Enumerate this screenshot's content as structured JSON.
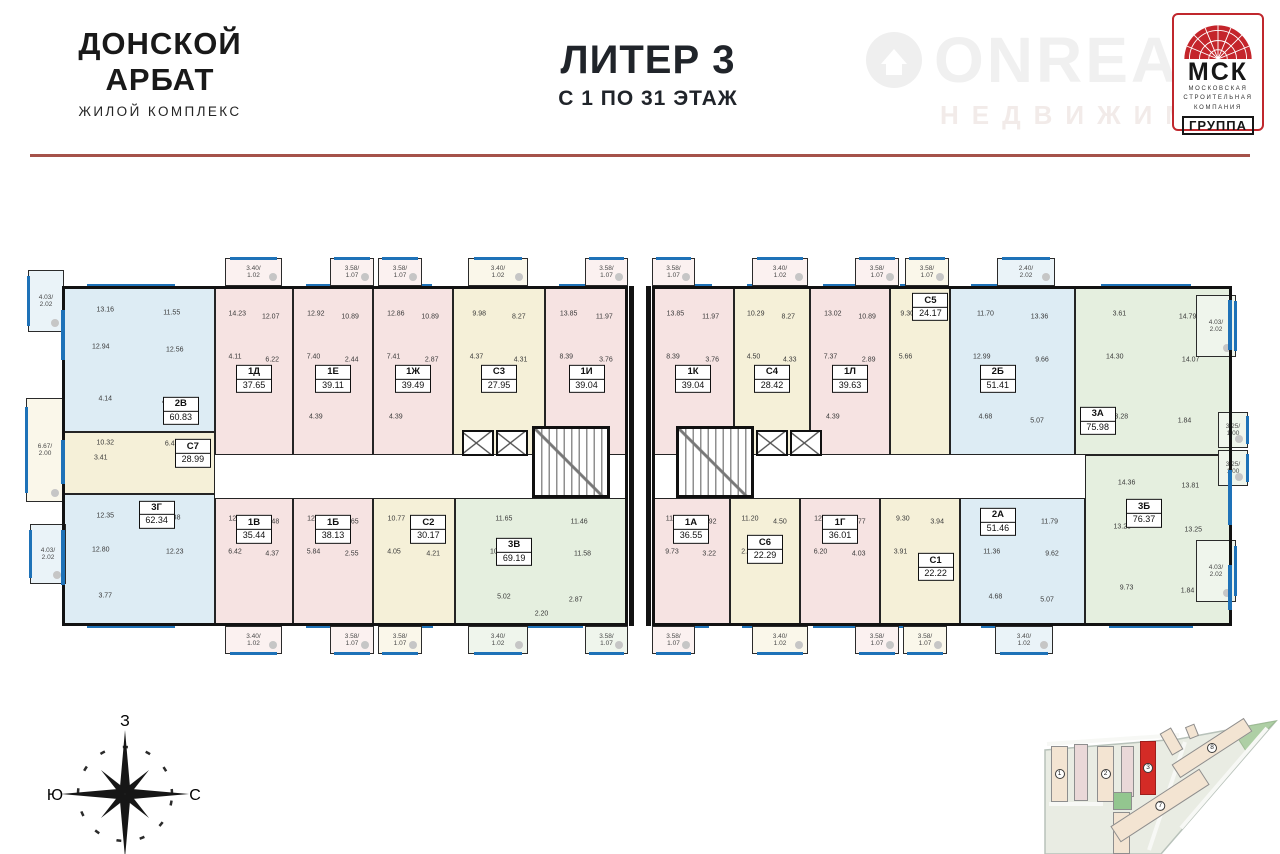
{
  "header": {
    "logo": {
      "line1": "ДОНСКОЙ",
      "line2": "АРБАТ",
      "subtitle": "ЖИЛОЙ КОМПЛЕКС"
    },
    "title": {
      "line1": "ЛИТЕР 3",
      "line2": "С 1 ПО 31 ЭТАЖ"
    },
    "watermark": {
      "word": "ONREA",
      "sub": "НЕДВИЖИМ"
    },
    "msk": {
      "abbr": "МСК",
      "lines": [
        "МОСКОВСКАЯ",
        "СТРОИТЕЛЬНАЯ",
        "КОМПАНИЯ"
      ],
      "group": "ГРУППА"
    }
  },
  "colors": {
    "apt": {
      "pink": "#f6e3e2",
      "blue": "#ddecf4",
      "cream": "#f5f0d8",
      "green": "#e5efdf"
    },
    "balc": {
      "pink": "#fbf1f0",
      "cream": "#faf7ea",
      "blue": "#eaf3f8",
      "green": "#eff5ec",
      "white": "#ffffff"
    },
    "window": "#1e72b8",
    "divider": "#a5524a",
    "site_red": "#d42b26"
  },
  "plan": {
    "apartments": [
      {
        "id": "2В",
        "area": "60.83",
        "c": "blue",
        "row": "top",
        "rect": [
          62,
          286,
          153,
          146
        ],
        "lx": 78,
        "ly": 86,
        "rooms": [
          "13.16",
          "11.55",
          "12.94",
          "12.56",
          "4.14",
          "4.46"
        ]
      },
      {
        "id": "С7",
        "area": "28.99",
        "c": "cream",
        "row": "mid",
        "rect": [
          62,
          432,
          153,
          62
        ],
        "lx": 86,
        "ly": 34,
        "rooms": [
          "10.32",
          "6.42",
          "3.41"
        ]
      },
      {
        "id": "3Г",
        "area": "62.34",
        "c": "blue",
        "row": "bottom",
        "rect": [
          62,
          494,
          153,
          132
        ],
        "lx": 62,
        "ly": 15,
        "rooms": [
          "12.35",
          "12.38",
          "12.80",
          "12.23",
          "3.77"
        ]
      },
      {
        "id": "1Д",
        "area": "37.65",
        "c": "pink",
        "row": "top",
        "rect": [
          215,
          286,
          78,
          169
        ],
        "rooms": [
          "14.23",
          "12.07",
          "4.11",
          "6.22"
        ]
      },
      {
        "id": "1Е",
        "area": "39.11",
        "c": "pink",
        "row": "top",
        "rect": [
          293,
          286,
          80,
          169
        ],
        "rooms": [
          "12.92",
          "10.89",
          "7.40",
          "2.44",
          "4.39"
        ]
      },
      {
        "id": "1Ж",
        "area": "39.49",
        "c": "pink",
        "row": "top",
        "rect": [
          373,
          286,
          80,
          169
        ],
        "rooms": [
          "12.86",
          "10.89",
          "7.41",
          "2.87",
          "4.39"
        ]
      },
      {
        "id": "С3",
        "area": "27.95",
        "c": "cream",
        "row": "top",
        "rect": [
          453,
          286,
          92,
          169
        ],
        "rooms": [
          "9.98",
          "8.27",
          "4.37",
          "4.31"
        ]
      },
      {
        "id": "1И",
        "area": "39.04",
        "c": "pink",
        "row": "top",
        "rect": [
          545,
          286,
          83,
          169
        ],
        "rooms": [
          "13.85",
          "11.97",
          "8.39",
          "3.76"
        ]
      },
      {
        "id": "1В",
        "area": "35.44",
        "c": "pink",
        "row": "bottom",
        "rect": [
          215,
          498,
          78,
          128
        ],
        "rooms": [
          "12.15",
          "11.48",
          "6.42",
          "4.37"
        ]
      },
      {
        "id": "1Б",
        "area": "38.13",
        "c": "pink",
        "row": "bottom",
        "rect": [
          293,
          498,
          80,
          128
        ],
        "rooms": [
          "12.97",
          "11.65",
          "5.84",
          "2.55"
        ]
      },
      {
        "id": "С2",
        "area": "30.17",
        "c": "cream",
        "row": "bottom",
        "rect": [
          373,
          498,
          82,
          128
        ],
        "lx": 68,
        "rooms": [
          "10.77",
          "10.07",
          "4.05",
          "4.21"
        ]
      },
      {
        "id": "3В",
        "area": "69.19",
        "c": "green",
        "row": "bottom",
        "rect": [
          455,
          498,
          173,
          128
        ],
        "lx": 34,
        "ly": 42,
        "rooms": [
          "11.65",
          "11.46",
          "10.86",
          "11.58",
          "5.02",
          "2.87",
          "2.20"
        ]
      },
      {
        "id": "1К",
        "area": "39.04",
        "c": "pink",
        "row": "top",
        "rect": [
          652,
          286,
          82,
          169
        ],
        "rooms": [
          "13.85",
          "11.97",
          "8.39",
          "3.76"
        ]
      },
      {
        "id": "С4",
        "area": "28.42",
        "c": "cream",
        "row": "top",
        "rect": [
          734,
          286,
          76,
          169
        ],
        "rooms": [
          "10.29",
          "8.27",
          "4.50",
          "4.33"
        ]
      },
      {
        "id": "1Л",
        "area": "39.63",
        "c": "pink",
        "row": "top",
        "rect": [
          810,
          286,
          80,
          169
        ],
        "rooms": [
          "13.02",
          "10.89",
          "7.37",
          "2.89",
          "4.39"
        ]
      },
      {
        "id": "С5",
        "area": "24.17",
        "c": "cream",
        "row": "top",
        "rect": [
          890,
          286,
          60,
          169
        ],
        "lx": 68,
        "ly": 12,
        "rooms": [
          "9.30",
          "3.75",
          "5.66"
        ]
      },
      {
        "id": "2Б",
        "area": "51.41",
        "c": "blue",
        "row": "top",
        "rect": [
          950,
          286,
          125,
          169
        ],
        "lx": 38,
        "rooms": [
          "11.70",
          "13.36",
          "12.99",
          "9.66",
          "4.68",
          "5.07"
        ]
      },
      {
        "id": "3А",
        "area": "75.98",
        "c": "green",
        "row": "top",
        "rect": [
          1075,
          286,
          157,
          169
        ],
        "lx": 14,
        "ly": 80,
        "rooms": [
          "3.61",
          "14.79",
          "14.30",
          "14.07",
          "13.28",
          "1.84"
        ]
      },
      {
        "id": "1А",
        "area": "36.55",
        "c": "pink",
        "row": "bottom",
        "rect": [
          652,
          498,
          78,
          128
        ],
        "rooms": [
          "11.61",
          "10.92",
          "9.73",
          "3.22"
        ]
      },
      {
        "id": "С6",
        "area": "22.29",
        "c": "cream",
        "row": "bottom",
        "rect": [
          730,
          498,
          70,
          128
        ],
        "ly": 40,
        "rooms": [
          "11.20",
          "4.50",
          "2.34"
        ]
      },
      {
        "id": "1Г",
        "area": "36.01",
        "c": "pink",
        "row": "bottom",
        "rect": [
          800,
          498,
          80,
          128
        ],
        "rooms": [
          "12.92",
          "11.77",
          "6.20",
          "4.03"
        ]
      },
      {
        "id": "С1",
        "area": "22.22",
        "c": "cream",
        "row": "bottom",
        "rect": [
          880,
          498,
          80,
          128
        ],
        "lx": 70,
        "ly": 54,
        "rooms": [
          "9.30",
          "3.94",
          "3.91"
        ]
      },
      {
        "id": "2А",
        "area": "51.46",
        "c": "blue",
        "row": "bottom",
        "rect": [
          960,
          498,
          125,
          128
        ],
        "lx": 30,
        "ly": 18,
        "rooms": [
          "12.99",
          "11.79",
          "11.36",
          "9.62",
          "4.68",
          "5.07"
        ]
      },
      {
        "id": "3Б",
        "area": "76.37",
        "c": "green",
        "row": "bottom",
        "rect": [
          1085,
          455,
          147,
          171
        ],
        "lx": 40,
        "ly": 34,
        "rooms": [
          "14.36",
          "13.81",
          "13.28",
          "13.25",
          "9.73",
          "1.84"
        ]
      }
    ],
    "balconies": [
      {
        "edge": "top",
        "rect": [
          225,
          258,
          57,
          28
        ],
        "label": "3.40/1.02",
        "tint": "pink"
      },
      {
        "edge": "top",
        "rect": [
          330,
          258,
          44,
          28
        ],
        "label": "3.58/1.07",
        "tint": "pink"
      },
      {
        "edge": "top",
        "rect": [
          378,
          258,
          44,
          28
        ],
        "label": "3.58/1.07",
        "tint": "pink"
      },
      {
        "edge": "top",
        "rect": [
          468,
          258,
          60,
          28
        ],
        "label": "3.40/1.02",
        "tint": "cream"
      },
      {
        "edge": "top",
        "rect": [
          585,
          258,
          43,
          28
        ],
        "label": "3.58/1.07",
        "tint": "pink"
      },
      {
        "edge": "top",
        "rect": [
          652,
          258,
          43,
          28
        ],
        "label": "3.58/1.07",
        "tint": "pink"
      },
      {
        "edge": "top",
        "rect": [
          752,
          258,
          56,
          28
        ],
        "label": "3.40/1.02",
        "tint": "pink"
      },
      {
        "edge": "top",
        "rect": [
          855,
          258,
          44,
          28
        ],
        "label": "3.58/1.07",
        "tint": "pink"
      },
      {
        "edge": "top",
        "rect": [
          905,
          258,
          44,
          28
        ],
        "label": "3.58/1.07",
        "tint": "cream"
      },
      {
        "edge": "top",
        "rect": [
          997,
          258,
          58,
          28
        ],
        "label": "2.40/2.02",
        "tint": "blue"
      },
      {
        "edge": "bottom",
        "rect": [
          225,
          626,
          57,
          28
        ],
        "label": "3.40/1.02",
        "tint": "pink"
      },
      {
        "edge": "bottom",
        "rect": [
          330,
          626,
          44,
          28
        ],
        "label": "3.58/1.07",
        "tint": "pink"
      },
      {
        "edge": "bottom",
        "rect": [
          378,
          626,
          44,
          28
        ],
        "label": "3.58/1.07",
        "tint": "cream"
      },
      {
        "edge": "bottom",
        "rect": [
          468,
          626,
          60,
          28
        ],
        "label": "3.40/1.02",
        "tint": "green"
      },
      {
        "edge": "bottom",
        "rect": [
          585,
          626,
          43,
          28
        ],
        "label": "3.58/1.07",
        "tint": "green"
      },
      {
        "edge": "bottom",
        "rect": [
          652,
          626,
          43,
          28
        ],
        "label": "3.58/1.07",
        "tint": "pink"
      },
      {
        "edge": "bottom",
        "rect": [
          752,
          626,
          56,
          28
        ],
        "label": "3.40/1.02",
        "tint": "cream"
      },
      {
        "edge": "bottom",
        "rect": [
          855,
          626,
          44,
          28
        ],
        "label": "3.58/1.07",
        "tint": "pink"
      },
      {
        "edge": "bottom",
        "rect": [
          903,
          626,
          44,
          28
        ],
        "label": "3.58/1.07",
        "tint": "cream"
      },
      {
        "edge": "bottom",
        "rect": [
          995,
          626,
          58,
          28
        ],
        "label": "3.40/1.02",
        "tint": "blue"
      },
      {
        "edge": "left",
        "rect": [
          28,
          270,
          36,
          62
        ],
        "label": "4.03/2.02",
        "tint": "blue"
      },
      {
        "edge": "left",
        "rect": [
          26,
          398,
          38,
          104
        ],
        "label": "6.67/2.00",
        "tint": "cream"
      },
      {
        "edge": "left",
        "rect": [
          30,
          524,
          36,
          60
        ],
        "label": "4.03/2.02",
        "tint": "blue"
      },
      {
        "edge": "right",
        "rect": [
          1196,
          295,
          40,
          62
        ],
        "label": "4.03/2.02",
        "tint": "green"
      },
      {
        "edge": "right",
        "rect": [
          1218,
          412,
          30,
          36
        ],
        "label": "3.25/1.00",
        "tint": "green"
      },
      {
        "edge": "right",
        "rect": [
          1218,
          450,
          30,
          36
        ],
        "label": "3.25/1.00",
        "tint": "green"
      },
      {
        "edge": "right",
        "rect": [
          1196,
          540,
          40,
          62
        ],
        "label": "4.03/2.02",
        "tint": "green"
      }
    ]
  },
  "compass": {
    "top": "З",
    "left": "Ю",
    "right": "С"
  },
  "siteplan": {
    "buildings": [
      {
        "rect": [
          18,
          30,
          17,
          56
        ],
        "rot": 0,
        "n": "1",
        "c": ""
      },
      {
        "rect": [
          41,
          28,
          14,
          57
        ],
        "rot": 0,
        "n": "",
        "c": "spk"
      },
      {
        "rect": [
          64,
          30,
          17,
          56
        ],
        "rot": 0,
        "n": "2",
        "c": ""
      },
      {
        "rect": [
          88,
          30,
          13,
          51
        ],
        "rot": 0,
        "n": "",
        "c": "spk"
      },
      {
        "rect": [
          107,
          25,
          16,
          54
        ],
        "rot": 0,
        "n": "3",
        "c": "red"
      },
      {
        "rect": [
          132,
          13,
          13,
          25
        ],
        "rot": -30,
        "n": "",
        "c": ""
      },
      {
        "rect": [
          154,
          9,
          10,
          13
        ],
        "rot": -22,
        "n": "",
        "c": ""
      },
      {
        "rect": [
          80,
          96,
          17,
          42
        ],
        "rot": 0,
        "n": "4",
        "c": ""
      },
      {
        "rect": [
          80,
          76,
          19,
          18
        ],
        "rot": 0,
        "n": "",
        "c": "green2"
      },
      {
        "rect": [
          74,
          80,
          106,
          19
        ],
        "rot": -33,
        "n": "7",
        "c": ""
      },
      {
        "rect": [
          136,
          24,
          86,
          16
        ],
        "rot": -33,
        "n": "8",
        "c": ""
      }
    ]
  }
}
